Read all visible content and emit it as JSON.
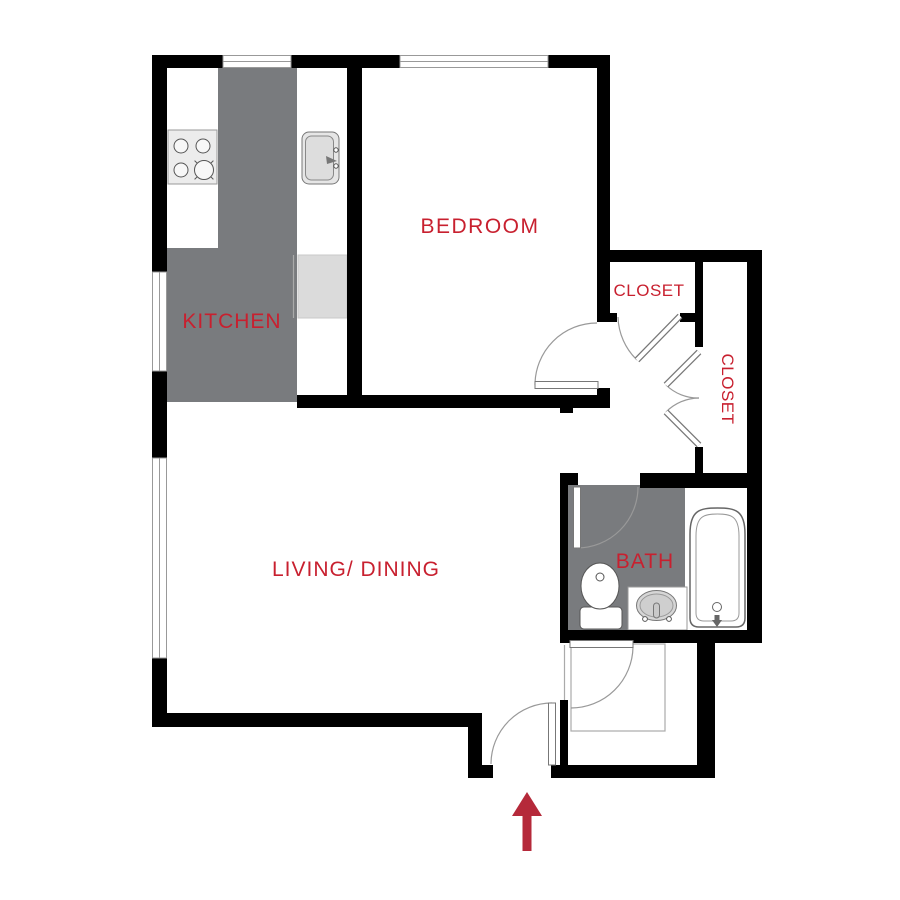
{
  "plan": {
    "type": "apartment-floor-plan",
    "labels": {
      "kitchen": "KITCHEN",
      "bedroom": "BEDROOM",
      "living_dining": "LIVING/ DINING",
      "closet_upper": "CLOSET",
      "closet_side": "CLOSET",
      "bath": "BATH"
    },
    "colors": {
      "wall": "#000000",
      "room_floor_gray": "#797B7E",
      "appliance_light_gray": "#DBDBDB",
      "stove_gray": "#ECECEC",
      "label_red": "#C8202F",
      "arrow_red": "#B5293A",
      "thin_line_gray": "#999999"
    },
    "fixtures": [
      "stove-icon",
      "kitchen-sink-icon",
      "dishwasher-icon",
      "toilet-icon",
      "vanity-sink-icon",
      "bathtub-icon"
    ],
    "entrance": {
      "icon": "entrance-arrow-icon",
      "direction": "up"
    }
  }
}
